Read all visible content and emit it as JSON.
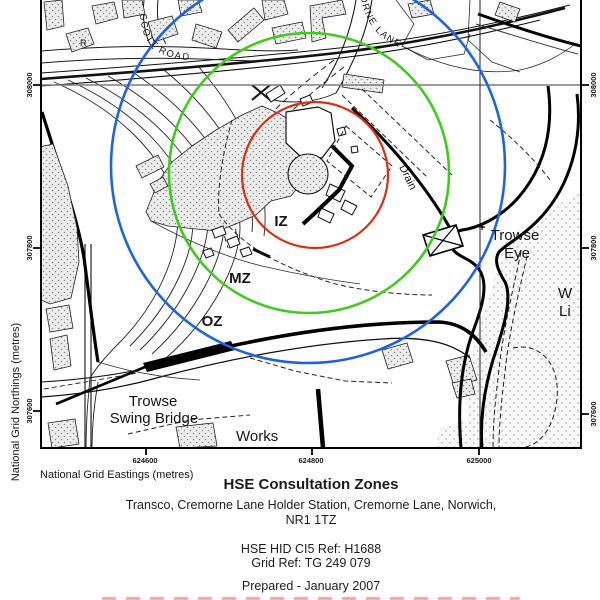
{
  "map": {
    "grid": {
      "y_axis_label": "National Grid Northings (metres)",
      "x_axis_label": "National Grid Eastings (metres)",
      "y_ticks": [
        "308000",
        "307800",
        "307600"
      ],
      "x_ticks": [
        "624600",
        "624800",
        "625000"
      ]
    },
    "zones": {
      "inner": {
        "label": "IZ",
        "color": "#d92f16"
      },
      "middle": {
        "label": "MZ",
        "color": "#3fca1c"
      },
      "outer": {
        "label": "OZ",
        "color": "#1e63e0"
      }
    },
    "labels": {
      "scott_road": "SCOTT ROAD",
      "cremorne_lane": "ORNE LANE",
      "drain": "Drain",
      "trowse_eye_1": "Trowse",
      "trowse_eye_2": "Eye",
      "swing_bridge_1": "Trowse",
      "swing_bridge_2": "Swing Bridge",
      "works": "Works",
      "r": "R",
      "w": "W",
      "li": "Li"
    }
  },
  "caption": {
    "title": "HSE Consultation Zones",
    "address_1": "Transco, Cremorne Lane Holder Station, Cremorne Lane, Norwich,",
    "address_2": "NR1 1TZ",
    "ref_1": "HSE HID CI5 Ref: H1688",
    "ref_2": "Grid Ref: TG 249 079",
    "prepared": "Prepared - January 2007"
  }
}
